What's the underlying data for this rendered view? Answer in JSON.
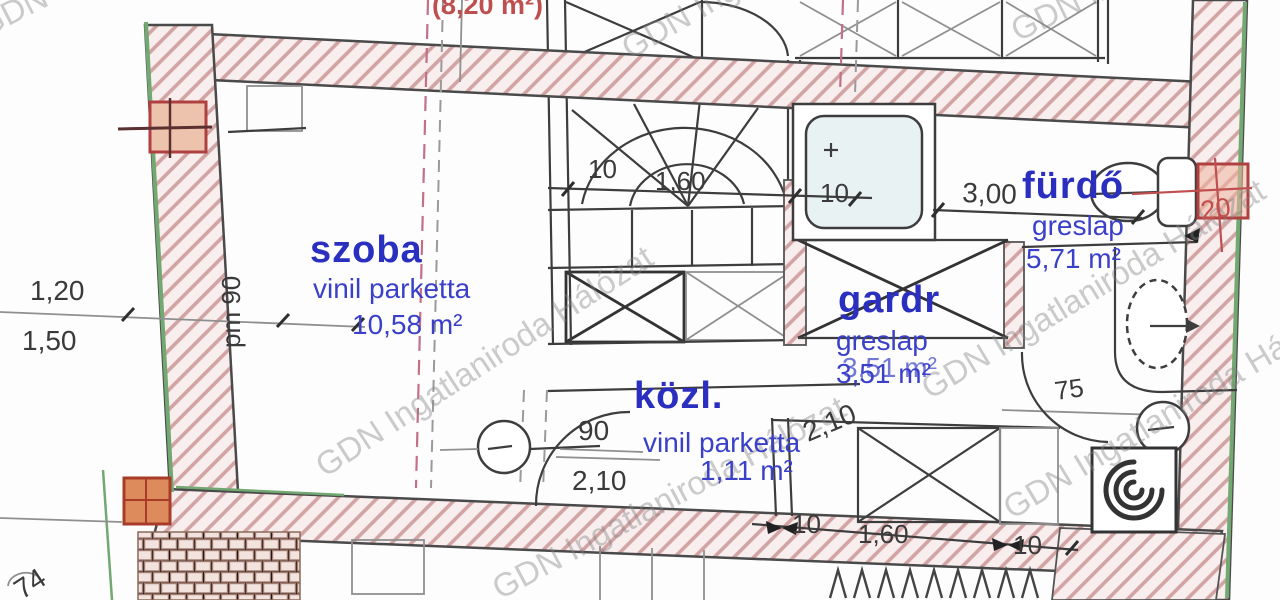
{
  "watermark": {
    "text": "GDN Ingatlaniroda Hálózat"
  },
  "labels": {
    "upper_area": "(8,20 m²)",
    "szoba": {
      "name": "szoba",
      "floor": "vinil parketta",
      "area": "10,58 m²"
    },
    "furdo": {
      "name": "fürdő",
      "floor": "greslap",
      "area": "5,71 m²"
    },
    "gardr": {
      "name": "gardr",
      "floor": "greslap",
      "area": "3,51 m²"
    },
    "kozl": {
      "name": "közl.",
      "floor": "vinil parketta",
      "area": "1,11 m²"
    }
  },
  "dims": {
    "left_upper": "1,20",
    "left_lower": "1,50",
    "parapet": "pm 90",
    "stair_top_left": "10",
    "stair_top_mid": "1,60",
    "stair_top_right": "10",
    "furdo_width": "3,00",
    "wall_thickness_right": "20",
    "kozl_door_width": "90",
    "kozl_width": "2,10",
    "kozl_diag": "2,10",
    "gardr_door_width": "75",
    "corner_bottom_left": "74",
    "bottom_left": "10",
    "bottom_mid": "1,60",
    "bottom_right": "10"
  },
  "colors": {
    "room_label_blue": "#2a2fc0",
    "wall_hatch_pink": "#d2a3a3",
    "boundary_green": "#72a872",
    "column_marker_red": "#b04040",
    "upper_area_red": "#bf4f4f",
    "dim_text_gray": "#3a3a3a"
  }
}
